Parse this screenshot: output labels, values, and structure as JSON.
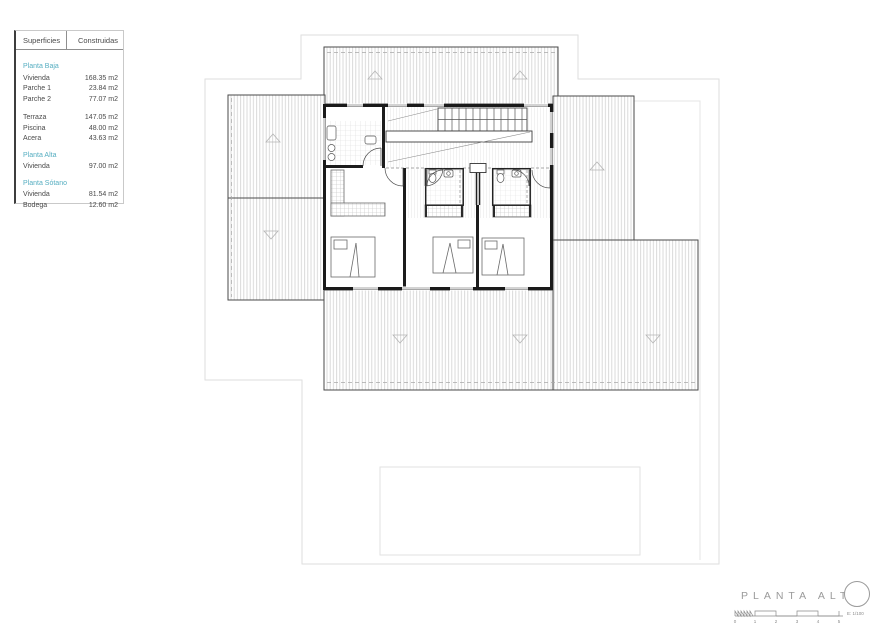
{
  "legend": {
    "header": {
      "col1": "Superficies",
      "col2": "Construidas"
    },
    "rows": [
      {
        "type": "section",
        "label": "Planta Baja"
      },
      {
        "type": "item",
        "label": "Vivienda",
        "value": "168.35 m2"
      },
      {
        "type": "item",
        "label": "Parche 1",
        "value": "23.84 m2"
      },
      {
        "type": "item",
        "label": "Parche 2",
        "value": "77.07 m2"
      },
      {
        "type": "spacer"
      },
      {
        "type": "item",
        "label": "Terraza",
        "value": "147.05 m2"
      },
      {
        "type": "item",
        "label": "Piscina",
        "value": "48.00 m2"
      },
      {
        "type": "item",
        "label": "Acera",
        "value": "43.63 m2"
      },
      {
        "type": "section",
        "label": "Planta Alta"
      },
      {
        "type": "item",
        "label": "Vivienda",
        "value": "97.00 m2"
      },
      {
        "type": "section",
        "label": "Planta Sótano"
      },
      {
        "type": "item",
        "label": "Vivienda",
        "value": "81.54 m2"
      },
      {
        "type": "item",
        "label": "Bodega",
        "value": "12.60 m2"
      }
    ]
  },
  "titleblock": {
    "title": "PLANTA ALTA",
    "scale_label": "E: 1/100",
    "scale_ticks": [
      "0",
      "1",
      "2",
      "3",
      "4",
      "5"
    ]
  },
  "colors": {
    "accent_teal": "#56aec1",
    "text_gray": "#4a4a4a",
    "title_gray": "#9a9a9a",
    "hatch_gray": "#d6d6d6"
  }
}
